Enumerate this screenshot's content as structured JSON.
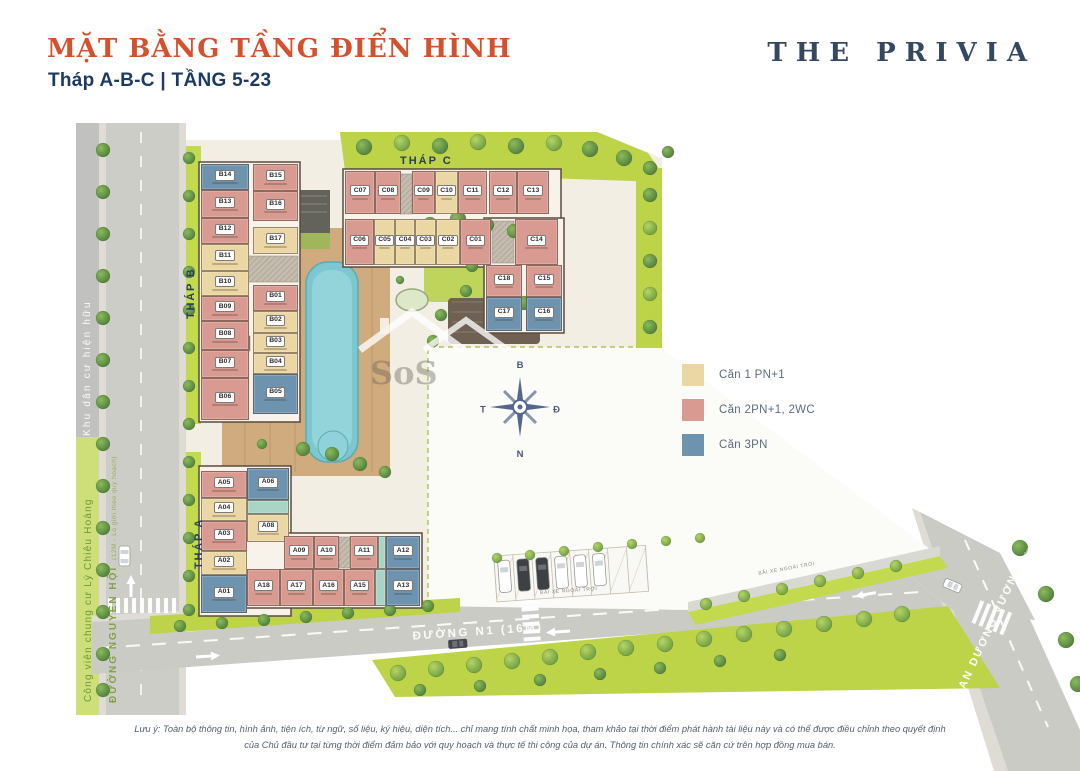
{
  "header": {
    "title": "MẶT BẰNG TẦNG ĐIỂN HÌNH",
    "subtitle": "Tháp A-B-C | TẦNG 5-23",
    "brand": "THE PRIVIA"
  },
  "colors": {
    "1pn": "#EBD7A3",
    "2pn": "#D89A91",
    "3pn": "#6E93AE",
    "teal": "#A9D5C6",
    "accent": "#D4512E",
    "navy": "#2C3E5C",
    "lawn": "#BDD348",
    "road": "#CDCDC8"
  },
  "legend": {
    "items": [
      {
        "label": "Căn 1 PN+1",
        "type": "1pn"
      },
      {
        "label": "Căn 2PN+1, 2WC",
        "type": "2pn"
      },
      {
        "label": "Căn 3PN",
        "type": "3pn"
      }
    ]
  },
  "compass": {
    "n": "B",
    "e": "Đ",
    "s": "N",
    "w": "T"
  },
  "towers": {
    "b": {
      "label": "THÁP B",
      "units": [
        {
          "id": "B14",
          "t": "3pn",
          "x": 201,
          "y": 164,
          "w": 48,
          "h": 26
        },
        {
          "id": "B13",
          "t": "2pn",
          "x": 201,
          "y": 190,
          "w": 48,
          "h": 28
        },
        {
          "id": "B12",
          "t": "2pn",
          "x": 201,
          "y": 218,
          "w": 48,
          "h": 26
        },
        {
          "id": "B11",
          "t": "1pn",
          "x": 201,
          "y": 244,
          "w": 48,
          "h": 27
        },
        {
          "id": "B10",
          "t": "1pn",
          "x": 201,
          "y": 271,
          "w": 48,
          "h": 25
        },
        {
          "id": "B09",
          "t": "2pn",
          "x": 201,
          "y": 296,
          "w": 48,
          "h": 25
        },
        {
          "id": "B08",
          "t": "2pn",
          "x": 201,
          "y": 321,
          "w": 48,
          "h": 29
        },
        {
          "id": "B07",
          "t": "2pn",
          "x": 201,
          "y": 350,
          "w": 48,
          "h": 28
        },
        {
          "id": "B06",
          "t": "2pn",
          "x": 201,
          "y": 378,
          "w": 48,
          "h": 42
        },
        {
          "id": "B15",
          "t": "2pn",
          "x": 253,
          "y": 164,
          "w": 45,
          "h": 27
        },
        {
          "id": "B16",
          "t": "2pn",
          "x": 253,
          "y": 191,
          "w": 45,
          "h": 30
        },
        {
          "id": "B17",
          "t": "1pn",
          "x": 253,
          "y": 227,
          "w": 45,
          "h": 27
        },
        {
          "id": "B01",
          "t": "2pn",
          "x": 253,
          "y": 285,
          "w": 45,
          "h": 26
        },
        {
          "id": "B02",
          "t": "1pn",
          "x": 253,
          "y": 311,
          "w": 45,
          "h": 22
        },
        {
          "id": "B03",
          "t": "1pn",
          "x": 253,
          "y": 333,
          "w": 45,
          "h": 20
        },
        {
          "id": "B04",
          "t": "1pn",
          "x": 253,
          "y": 353,
          "w": 45,
          "h": 21
        },
        {
          "id": "B05",
          "t": "3pn",
          "x": 253,
          "y": 374,
          "w": 45,
          "h": 40
        }
      ]
    },
    "c": {
      "label": "THÁP C",
      "units": [
        {
          "id": "C07",
          "t": "2pn",
          "x": 345,
          "y": 171,
          "w": 30,
          "h": 43
        },
        {
          "id": "C08",
          "t": "2pn",
          "x": 375,
          "y": 171,
          "w": 26,
          "h": 43
        },
        {
          "id": "C09",
          "t": "2pn",
          "x": 412,
          "y": 171,
          "w": 23,
          "h": 43
        },
        {
          "id": "C10",
          "t": "1pn",
          "x": 435,
          "y": 171,
          "w": 23,
          "h": 43
        },
        {
          "id": "C11",
          "t": "2pn",
          "x": 458,
          "y": 171,
          "w": 29,
          "h": 43
        },
        {
          "id": "C12",
          "t": "2pn",
          "x": 489,
          "y": 171,
          "w": 28,
          "h": 43
        },
        {
          "id": "C13",
          "t": "2pn",
          "x": 517,
          "y": 171,
          "w": 32,
          "h": 43
        },
        {
          "id": "C06",
          "t": "2pn",
          "x": 345,
          "y": 219,
          "w": 29,
          "h": 46
        },
        {
          "id": "C05",
          "t": "1pn",
          "x": 374,
          "y": 219,
          "w": 21,
          "h": 46
        },
        {
          "id": "C04",
          "t": "1pn",
          "x": 395,
          "y": 219,
          "w": 20,
          "h": 46
        },
        {
          "id": "C03",
          "t": "1pn",
          "x": 415,
          "y": 219,
          "w": 21,
          "h": 46
        },
        {
          "id": "C02",
          "t": "1pn",
          "x": 436,
          "y": 219,
          "w": 24,
          "h": 46
        },
        {
          "id": "C01",
          "t": "2pn",
          "x": 460,
          "y": 219,
          "w": 31,
          "h": 46
        },
        {
          "id": "C14",
          "t": "2pn",
          "x": 515,
          "y": 219,
          "w": 43,
          "h": 46
        },
        {
          "id": "C18",
          "t": "2pn",
          "x": 486,
          "y": 265,
          "w": 36,
          "h": 32
        },
        {
          "id": "C15",
          "t": "2pn",
          "x": 526,
          "y": 265,
          "w": 36,
          "h": 32
        },
        {
          "id": "C17",
          "t": "3pn",
          "x": 486,
          "y": 297,
          "w": 36,
          "h": 34
        },
        {
          "id": "C16",
          "t": "3pn",
          "x": 526,
          "y": 297,
          "w": 36,
          "h": 34
        }
      ]
    },
    "a": {
      "label": "THÁP A",
      "units": [
        {
          "id": "A05",
          "t": "2pn",
          "x": 201,
          "y": 471,
          "w": 46,
          "h": 27
        },
        {
          "id": "A04",
          "t": "1pn",
          "x": 201,
          "y": 498,
          "w": 46,
          "h": 23
        },
        {
          "id": "A03",
          "t": "2pn",
          "x": 201,
          "y": 521,
          "w": 46,
          "h": 30
        },
        {
          "id": "A02",
          "t": "1pn",
          "x": 201,
          "y": 551,
          "w": 46,
          "h": 24
        },
        {
          "id": "A01",
          "t": "3pn",
          "x": 201,
          "y": 575,
          "w": 46,
          "h": 38
        },
        {
          "id": "A06",
          "t": "3pn",
          "x": 247,
          "y": 468,
          "w": 42,
          "h": 32
        },
        {
          "id": "",
          "t": "teal",
          "x": 247,
          "y": 500,
          "w": 42,
          "h": 14
        },
        {
          "id": "A08",
          "t": "1pn",
          "x": 247,
          "y": 514,
          "w": 42,
          "h": 28
        },
        {
          "id": "A09",
          "t": "2pn",
          "x": 284,
          "y": 536,
          "w": 30,
          "h": 33
        },
        {
          "id": "A10",
          "t": "2pn",
          "x": 314,
          "y": 536,
          "w": 25,
          "h": 33
        },
        {
          "id": "A11",
          "t": "2pn",
          "x": 350,
          "y": 536,
          "w": 28,
          "h": 33
        },
        {
          "id": "",
          "t": "teal",
          "x": 378,
          "y": 536,
          "w": 8,
          "h": 33
        },
        {
          "id": "A12",
          "t": "3pn",
          "x": 386,
          "y": 536,
          "w": 34,
          "h": 33
        },
        {
          "id": "A18",
          "t": "2pn",
          "x": 247,
          "y": 569,
          "w": 33,
          "h": 37
        },
        {
          "id": "A17",
          "t": "2pn",
          "x": 280,
          "y": 569,
          "w": 33,
          "h": 37
        },
        {
          "id": "A16",
          "t": "2pn",
          "x": 313,
          "y": 569,
          "w": 31,
          "h": 37
        },
        {
          "id": "A15",
          "t": "2pn",
          "x": 344,
          "y": 569,
          "w": 31,
          "h": 37
        },
        {
          "id": "",
          "t": "teal",
          "x": 375,
          "y": 569,
          "w": 11,
          "h": 37
        },
        {
          "id": "A13",
          "t": "3pn",
          "x": 386,
          "y": 569,
          "w": 34,
          "h": 37
        }
      ]
    }
  },
  "roads": {
    "nguyen_hoi": {
      "name": "ĐƯỜNG NGUYỄN HỘI",
      "detail": "(12M - Lộ giới theo quy hoạch)"
    },
    "n1": {
      "name": "ĐƯỜNG N1 (16M)"
    },
    "an_duong_vuong": {
      "name": "AN DƯƠNG VƯƠNG",
      "detail": "(30m - Lộ giới theo QH)"
    }
  },
  "areas": {
    "residential": "Khu dân cư hiện hữu",
    "park": "Công viên chung cư  Lý Chiêu Hoàng",
    "parking": "BÃI XE NGOÀI TRỜI"
  },
  "watermark": "SoS",
  "footer": {
    "line1": "Lưu ý: Toàn bộ thông tin, hình ảnh, tiện ích, từ ngữ, số liệu, ký hiệu, diện tích... chỉ mang tính chất minh họa, tham khảo tại thời điểm phát hành tài liệu này và có thể được điều chỉnh theo quyết định",
    "line2": "của Chủ đầu tư tại từng thời điểm đảm bảo với quy hoạch và thực tế thi công của dự án. Thông tin chính xác sẽ căn cứ trên hợp đồng mua bán."
  }
}
